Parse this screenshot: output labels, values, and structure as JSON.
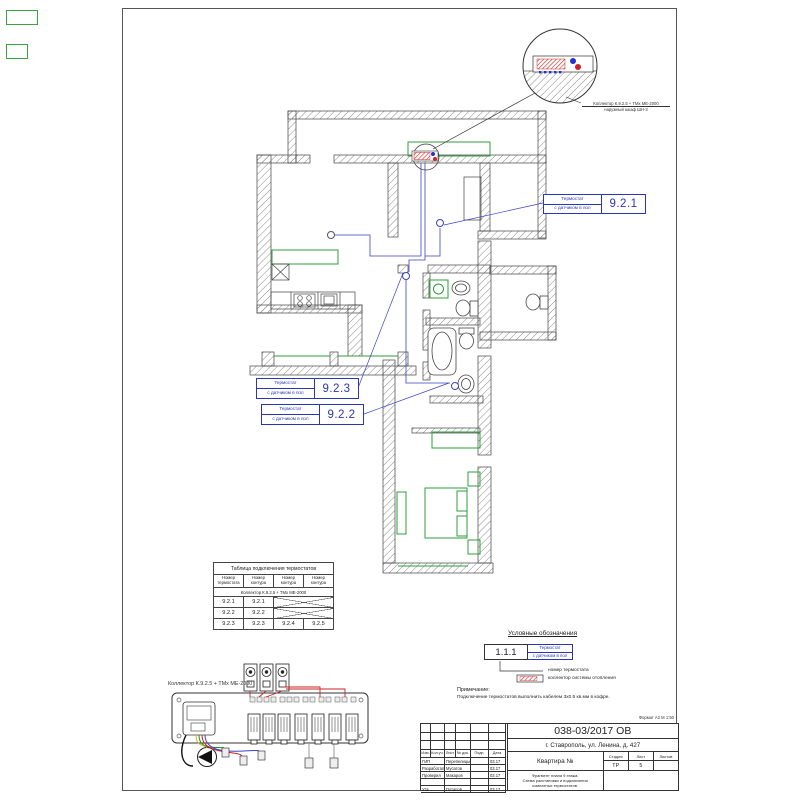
{
  "sheet": {
    "format_note": "Формат А2  М 1:50"
  },
  "detail_callout": {
    "line1": "Коллектор К.9.2.5 + ТМх МЕ-2000",
    "line2": "наружный шкаф ШН-3"
  },
  "callouts": {
    "label_line1": "Термостат",
    "label_line2": "с датчиком в пол",
    "t921": "9.2.1",
    "t922": "9.2.2",
    "t923": "9.2.3"
  },
  "connection_table": {
    "title": "Таблица подключения термостатов",
    "col1_line1": "Номер",
    "col1_line2": "термостата",
    "col2_line1": "Номер",
    "col2_line2": "контура",
    "collector_row": "Коллектор К.9.2.5 + ТМх МЕ-2000",
    "rows": [
      {
        "thermostat": "9.2.1",
        "loop1": "9.2.1",
        "loop2": "",
        "loop3": ""
      },
      {
        "thermostat": "9.2.2",
        "loop1": "9.2.2",
        "loop2": "",
        "loop3": ""
      },
      {
        "thermostat": "9.2.3",
        "loop1": "9.2.3",
        "loop2": "9.2.4",
        "loop3": "9.2.5"
      }
    ]
  },
  "manifold_diagram": {
    "label": "Коллектор К.9.2.5 + ТМх МЕ-2000"
  },
  "legend": {
    "title": "Условные обозначения",
    "item_number": "1.1.1",
    "item_line1": "Термостат",
    "item_line2": "с датчиком в пол",
    "caption_number": "номер термостата",
    "caption_collector": "коллектор системы отопления",
    "note_title": "Примечание:",
    "note_text": "Подключение термостатов выполнить кабелем 3х0.5 кв.мм в кофре."
  },
  "title_block": {
    "doc_number": "038-03/2017 ОВ",
    "address": "г. Ставрополь, ул. Ленина, д. 427",
    "object_label": "Квартира №",
    "description_line1": "Фрагмент плана 9 этажа.",
    "description_line2": "Схема расстановки и подключения",
    "description_line3": "комнатных термостатов.",
    "stage_label": "Стадия",
    "sheet_label": "Лист",
    "sheets_label": "Листов",
    "stage_value": "ТР",
    "sheet_value": "5",
    "sheets_value": "",
    "columns": {
      "c1": "Изм.",
      "c2": "Кол.уч.",
      "c3": "Лист",
      "c4": "№ док.",
      "c5": "Подп.",
      "c6": "Дата"
    },
    "rows": [
      {
        "role": "ГИП",
        "name": "Перепелицын",
        "date": "03.17"
      },
      {
        "role": "Разработал",
        "name": "Мусатов",
        "date": "03.17"
      },
      {
        "role": "Проверил",
        "name": "Макаров",
        "date": "03.17"
      },
      {
        "role": "",
        "name": "",
        "date": ""
      },
      {
        "role": "Утв.",
        "name": "Потапов",
        "date": "03.17"
      }
    ]
  },
  "colors": {
    "callout_blue": "#2b35b8",
    "wire_blue": "#3a43c4",
    "furniture_green": "#2e9e3e",
    "collector_red": "#cc2222",
    "wall_hatch": "#777777"
  }
}
